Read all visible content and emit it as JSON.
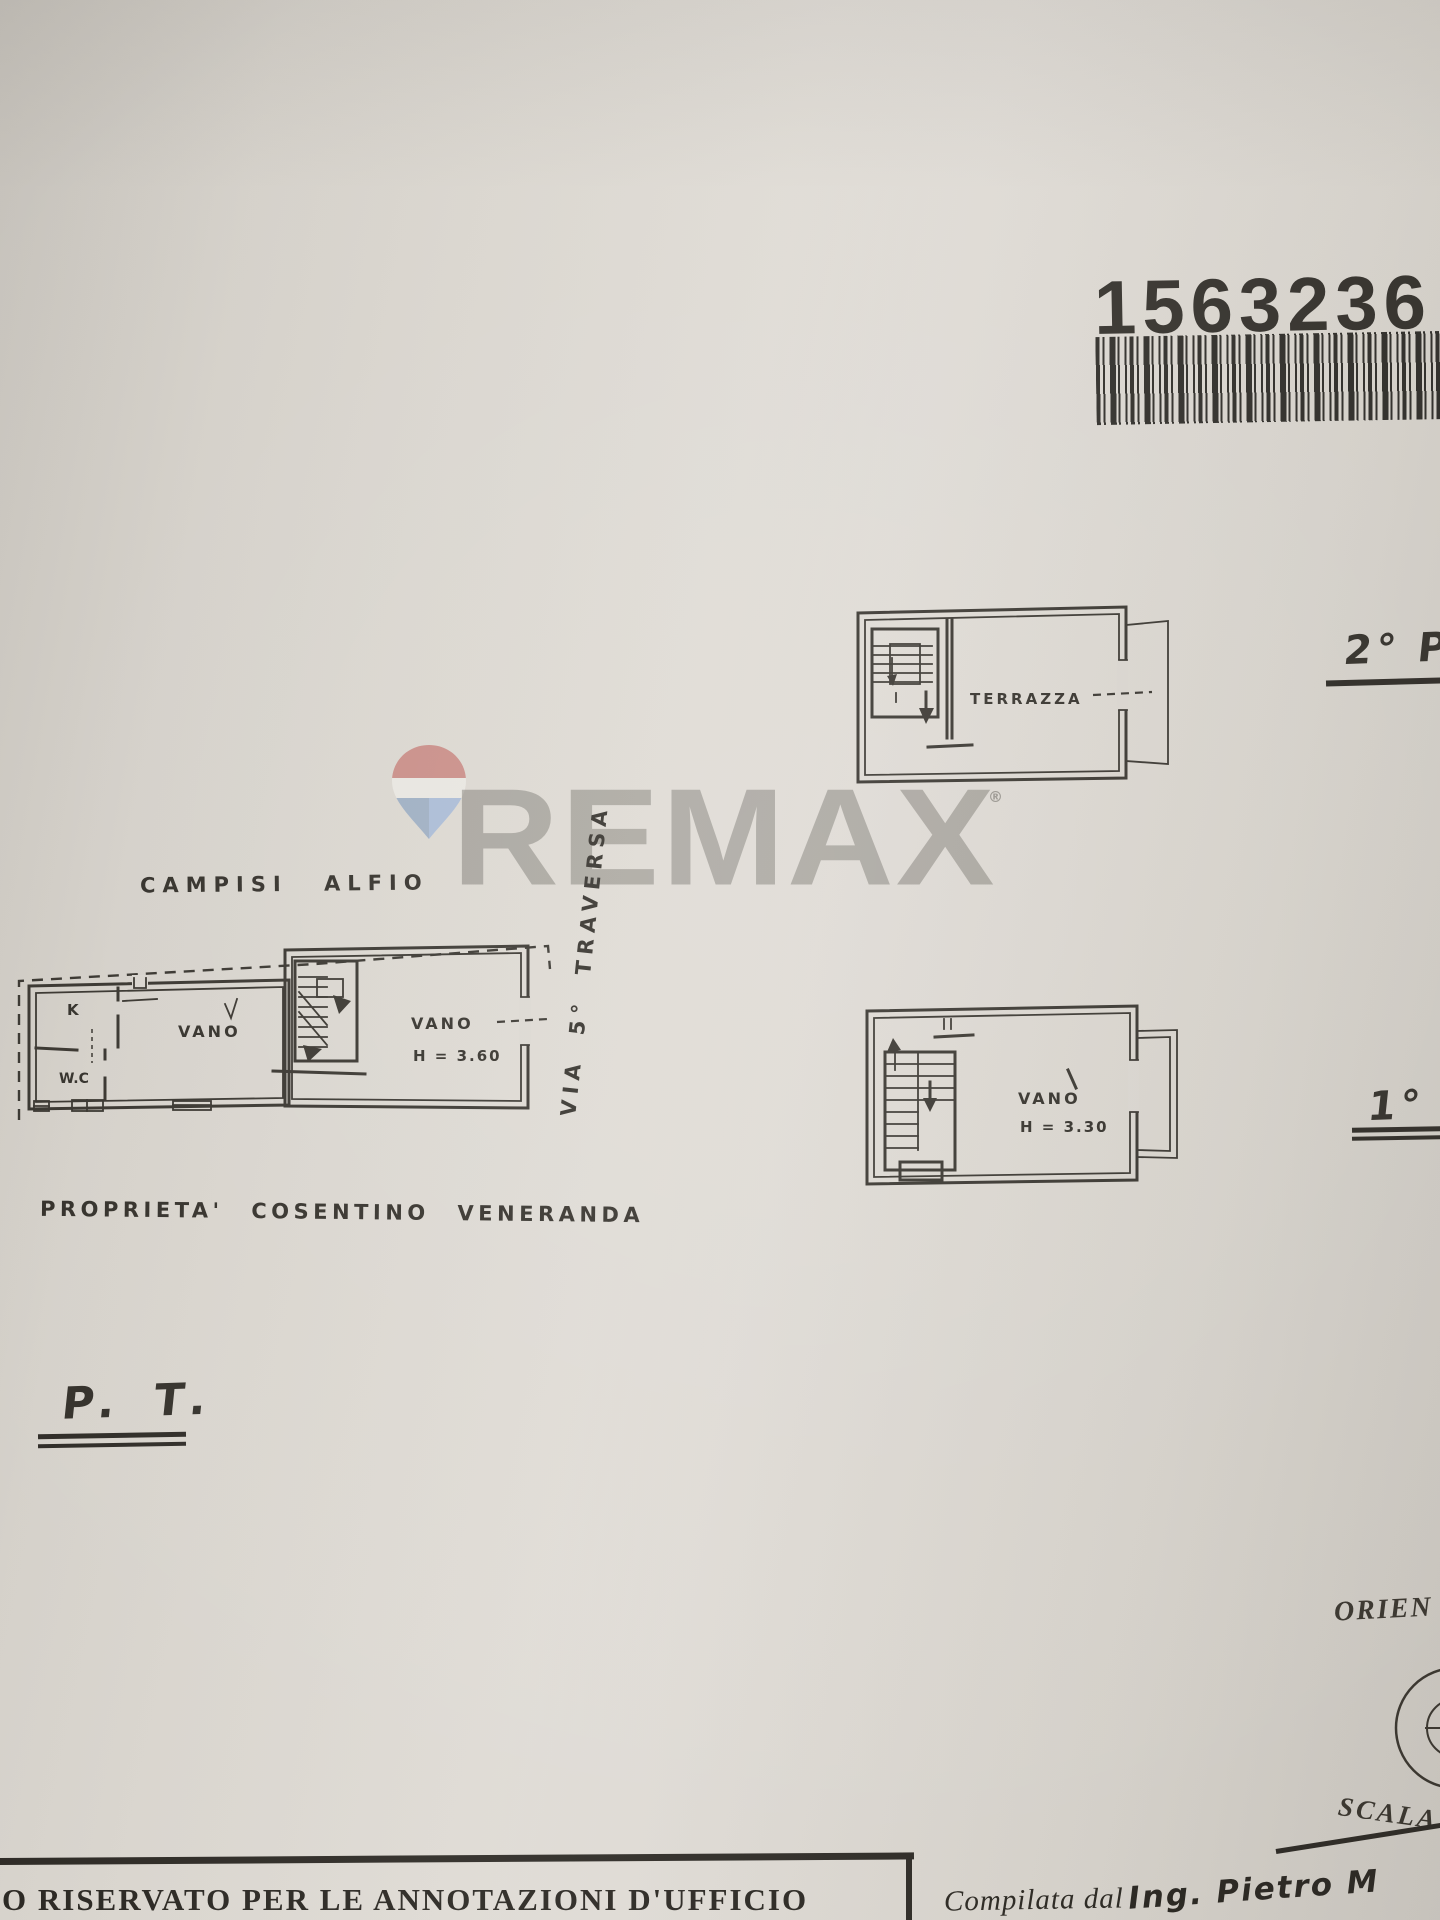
{
  "document": {
    "paper_color": "#dcd8d1",
    "ink_color": "#38352f",
    "barcode": {
      "number": "1563236"
    },
    "watermark": {
      "brand": "REMAX",
      "registered_mark": "®",
      "balloon_red": "#c8827c",
      "balloon_white": "#eceae5",
      "balloon_blue": "#a3b8d8"
    },
    "floors": {
      "second": {
        "title": "2° P.",
        "terrace_label": "TERRAZZA"
      },
      "first": {
        "title": "1° P.",
        "room_label": "VANO",
        "room_height": "H = 3.30"
      },
      "ground": {
        "title": "P. T.",
        "owner_header": "CAMPISI ALFIO",
        "kitchen_label": "K",
        "wc_label": "W.C",
        "living_label": "VANO",
        "stair_room_label": "VANO",
        "stair_room_height": "H = 3.60",
        "street_label": "VIA 5° TRAVERSA",
        "owner_footer": "PROPRIETA' COSENTINO VENERANDA"
      }
    },
    "margins": {
      "orientation_label": "ORIEN",
      "scale_label": "SCALA",
      "office_note": "O RISERVATO PER LE ANNOTAZIONI D'UFFICIO",
      "compiled_by_printed": "Compilata dal",
      "compiled_by_handwritten": "Ing. Pietro M"
    }
  }
}
